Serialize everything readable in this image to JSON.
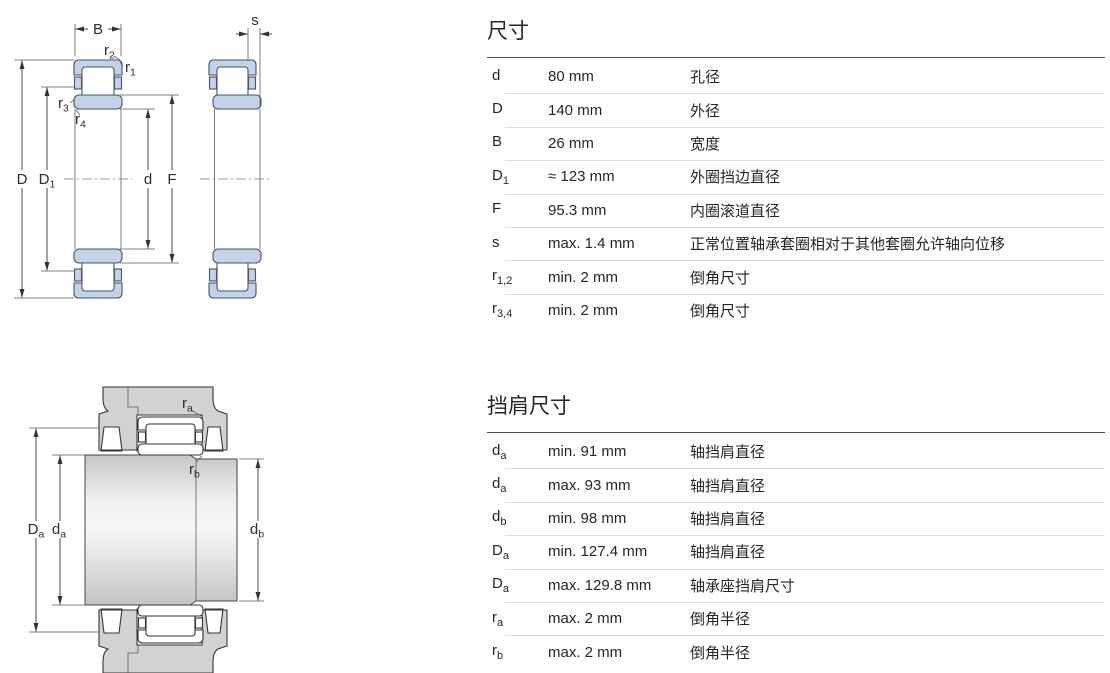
{
  "page": {
    "background": "#ffffff"
  },
  "colors": {
    "bearing_fill": "#c3d1e9",
    "bearing_stroke": "#4a5361",
    "housing_fill": "#d2d2d2",
    "shaft_light": "#f7f7f5",
    "shaft_dark": "#c6c6c4",
    "line": "#333333",
    "title_rule": "#4f4f4f",
    "row_divider": "#dcdcdc",
    "text": "#262626"
  },
  "drawings": {
    "top_section_view": {
      "labels": {
        "width": "B",
        "axial_displacement": "s",
        "outside_diameter": "D",
        "flange_base": "D",
        "flange_sub": "1",
        "bore_diameter": "d",
        "raceway_diameter": "F",
        "r_base": "r",
        "r1_sub": "1",
        "r2_sub": "2",
        "r3_sub": "3",
        "r4_sub": "4"
      }
    },
    "mounting_view": {
      "labels": {
        "shaft_base": "d",
        "da_sub": "a",
        "db_sub": "b",
        "housing_base": "D",
        "Da_sub": "a",
        "fillet_base": "r",
        "ra_sub": "a",
        "rb_sub": "b"
      }
    }
  },
  "dimensions_table": {
    "title": "尺寸",
    "rows": [
      {
        "sym": "d",
        "sub": "",
        "value": "80 mm",
        "desc": "孔径"
      },
      {
        "sym": "D",
        "sub": "",
        "value": "140 mm",
        "desc": "外径"
      },
      {
        "sym": "B",
        "sub": "",
        "value": "26 mm",
        "desc": "宽度"
      },
      {
        "sym": "D",
        "sub": "1",
        "value": "≈ 123 mm",
        "desc": "外圈挡边直径"
      },
      {
        "sym": "F",
        "sub": "",
        "value": "95.3 mm",
        "desc": "内圈滚道直径"
      },
      {
        "sym": "s",
        "sub": "",
        "value": "max. 1.4 mm",
        "desc": "正常位置轴承套圈相对于其他套圈允许轴向位移"
      },
      {
        "sym": "r",
        "sub": "1,2",
        "value": "min. 2 mm",
        "desc": "倒角尺寸"
      },
      {
        "sym": "r",
        "sub": "3,4",
        "value": "min. 2 mm",
        "desc": "倒角尺寸"
      }
    ]
  },
  "abutment_table": {
    "title": "挡肩尺寸",
    "rows": [
      {
        "sym": "d",
        "sub": "a",
        "value": "min. 91 mm",
        "desc": "轴挡肩直径"
      },
      {
        "sym": "d",
        "sub": "a",
        "value": "max. 93 mm",
        "desc": "轴挡肩直径"
      },
      {
        "sym": "d",
        "sub": "b",
        "value": "min. 98 mm",
        "desc": "轴挡肩直径"
      },
      {
        "sym": "D",
        "sub": "a",
        "value": "min. 127.4 mm",
        "desc": "轴挡肩直径"
      },
      {
        "sym": "D",
        "sub": "a",
        "value": "max. 129.8 mm",
        "desc": "轴承座挡肩尺寸"
      },
      {
        "sym": "r",
        "sub": "a",
        "value": "max. 2 mm",
        "desc": "倒角半径"
      },
      {
        "sym": "r",
        "sub": "b",
        "value": "max. 2 mm",
        "desc": "倒角半径"
      }
    ]
  }
}
